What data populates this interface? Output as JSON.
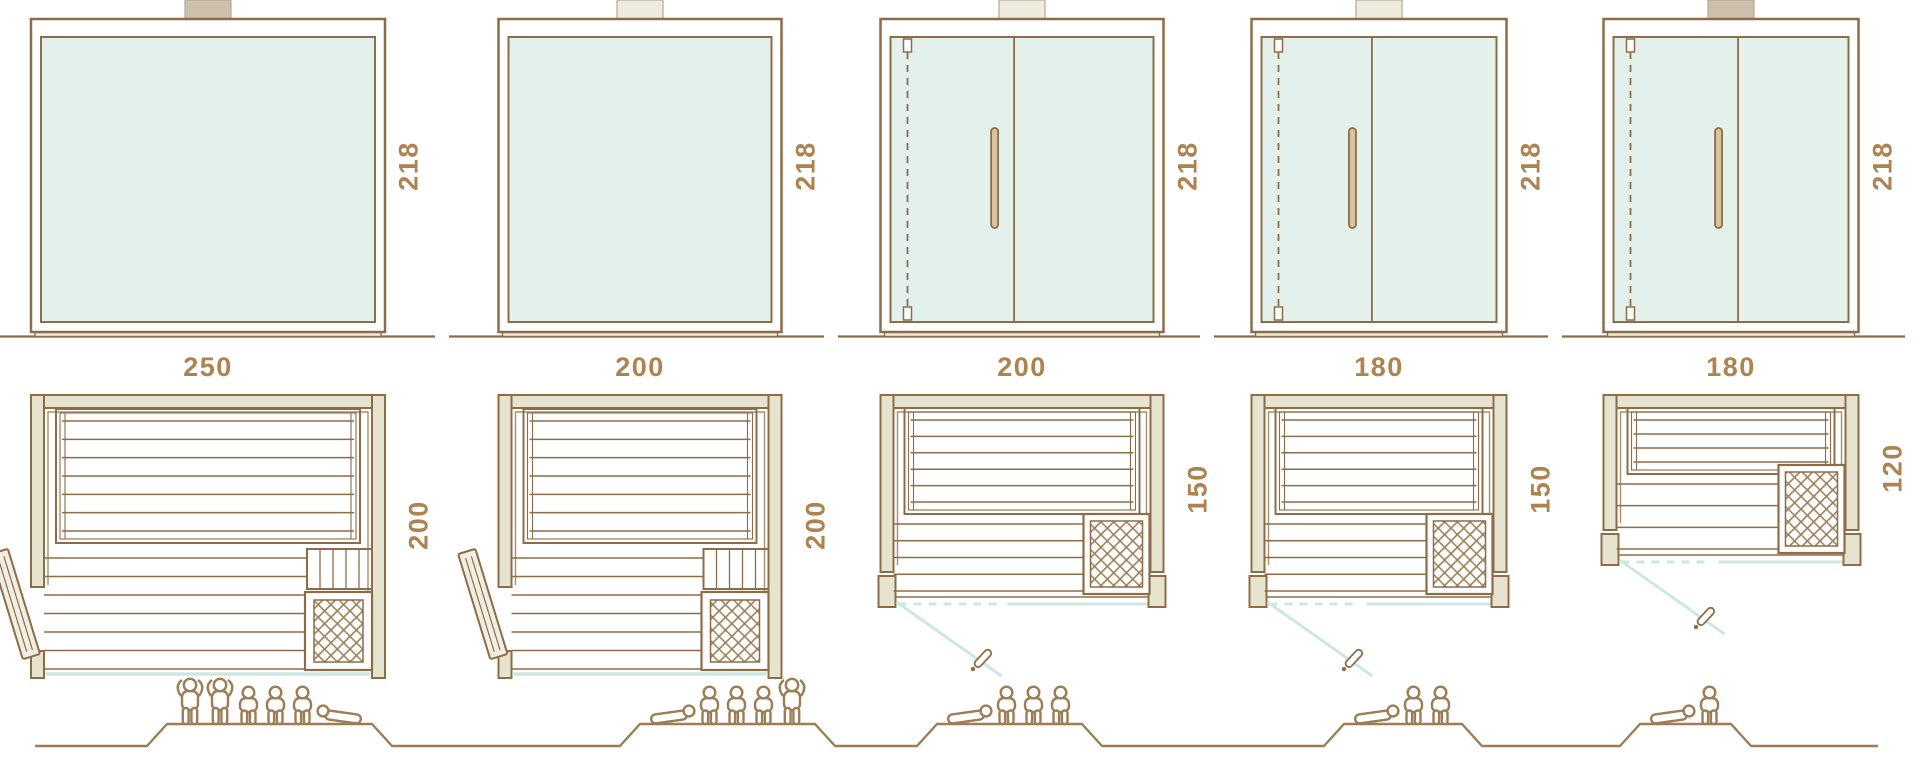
{
  "diagram_title": "Sauna cabin size comparison — front elevations, floor plans and seating capacity",
  "colors": {
    "line": "#8d6c48",
    "line_soft": "#a98e69",
    "wall_fill": "#e6e3ce",
    "glass_fill": "#e3f0ec",
    "teal_line": "#cde7e2",
    "label_text": "#ac8351",
    "tab_dark": "#cdc0ad",
    "tab_light": "#edeae0",
    "handle_fill": "#d8c3a1",
    "door_leaf_fill": "#f1efe3",
    "sill_fill": "#f0ebdf",
    "people_line": "#9c7d55",
    "background": "#ffffff"
  },
  "units": [
    {
      "front_width_cm": 250,
      "front_height_cm": 218,
      "plan_depth_cm": 200,
      "width_label": "250",
      "height_label": "218",
      "depth_label": "200",
      "front_type": "panoramic-glass",
      "door": "side-wall-hinged-door-left",
      "heater": "corner-heater-front-right",
      "capacity": 6,
      "people": [
        "standing",
        "standing",
        "sitting",
        "sitting",
        "sitting",
        "lying-head-left"
      ]
    },
    {
      "front_width_cm": 200,
      "front_height_cm": 218,
      "plan_depth_cm": 200,
      "width_label": "200",
      "height_label": "218",
      "depth_label": "200",
      "front_type": "panoramic-glass",
      "door": "side-wall-hinged-door-left",
      "heater": "corner-heater-front-right",
      "capacity": 5,
      "people": [
        "lying-head-right",
        "sitting",
        "sitting",
        "sitting",
        "standing"
      ]
    },
    {
      "front_width_cm": 200,
      "front_height_cm": 218,
      "plan_depth_cm": 150,
      "width_label": "200",
      "height_label": "218",
      "depth_label": "150",
      "front_type": "glass-front-with-door",
      "door": "front-glass-door-hinged-left",
      "heater": "corner-heater-front-right",
      "capacity": 4,
      "people": [
        "lying-head-right",
        "sitting",
        "sitting",
        "sitting"
      ]
    },
    {
      "front_width_cm": 180,
      "front_height_cm": 218,
      "plan_depth_cm": 150,
      "width_label": "180",
      "height_label": "218",
      "depth_label": "150",
      "front_type": "glass-front-with-door",
      "door": "front-glass-door-hinged-left",
      "heater": "corner-heater-front-right",
      "capacity": 3,
      "people": [
        "lying-head-right",
        "sitting",
        "sitting"
      ]
    },
    {
      "front_width_cm": 180,
      "front_height_cm": 218,
      "plan_depth_cm": 120,
      "width_label": "180",
      "height_label": "218",
      "depth_label": "120",
      "front_type": "glass-front-with-door",
      "door": "front-glass-door-hinged-left",
      "heater": "side-heater-right",
      "capacity": 2,
      "people": [
        "lying-head-right",
        "sitting"
      ]
    }
  ]
}
